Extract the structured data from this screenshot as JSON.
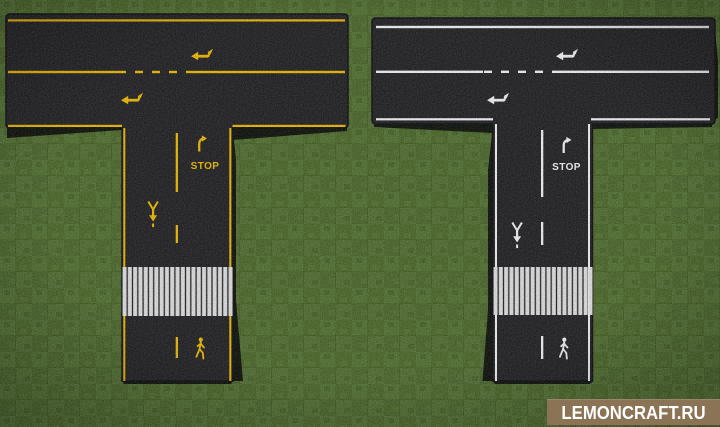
{
  "canvas": {
    "width": 720,
    "height": 427
  },
  "scene": {
    "grass_color": "#536b38",
    "asphalt_color": "#2b2b2e",
    "road_edge_color": "#1a1a1d",
    "shadow_color": "#101012"
  },
  "roads": {
    "left": {
      "marking_color": "#dcb011",
      "stop_label": "STOP"
    },
    "right": {
      "marking_color": "#e2e2e2",
      "stop_label": "STOP"
    },
    "crosswalk_stripe_color": "#d2d2d2"
  },
  "watermark": {
    "label": "LEMONCRAFT.RU",
    "background_color": "#8b7355",
    "text_color": "#ffffff"
  }
}
